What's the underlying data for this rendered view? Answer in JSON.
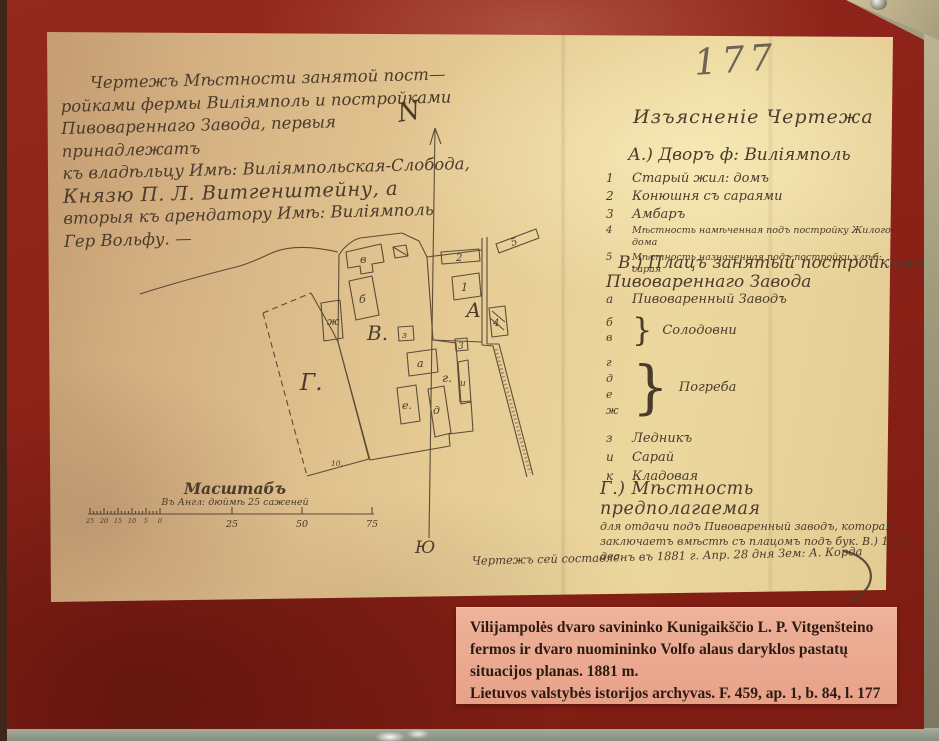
{
  "archive_number": "177",
  "title_block": {
    "lines": [
      "Чертежъ Мѣстности занятой пост—",
      "ройками фермы Виліямполь и постройками",
      "Пивовареннаго Завода, первыя принадлежатъ",
      "къ владѣльцу Имѣ: Виліямпольская-Слобода,",
      "Князю П. Л. Витгенштейну, а",
      "вторыя къ арендатору Имѣ: Виліямполь",
      "Гер Вольфу. —"
    ]
  },
  "legend": {
    "heading": "Изъясненіе Чертежа",
    "section_a": {
      "heading": "А.) Дворъ ф: Виліямполь",
      "items": [
        {
          "key": "1",
          "text": "Старый жил: домъ"
        },
        {
          "key": "2",
          "text": "Конюшня съ сараями"
        },
        {
          "key": "3",
          "text": "Амбаръ"
        },
        {
          "key": "4",
          "text": "Мѣстность намѣченная подъ постройку Жилого дома"
        },
        {
          "key": "5",
          "text": "Мѣстность назначенная подъ постройки хлѣб: сарая"
        }
      ]
    },
    "section_b": {
      "heading_line1": "В.) Плацъ занятый постройками",
      "heading_line2": "Пивовареннаго Завода",
      "item_a": {
        "key": "а",
        "text": "Пивоваренный Заводъ"
      },
      "group_solodovni": {
        "keys": [
          "б",
          "в"
        ],
        "text": "Солодовни"
      },
      "group_pogreba": {
        "keys": [
          "г",
          "д",
          "е",
          "ж"
        ],
        "text": "Погреба"
      },
      "items": [
        {
          "key": "з",
          "text": "Ледникъ"
        },
        {
          "key": "и",
          "text": "Сарай"
        },
        {
          "key": "к",
          "text": "Кладовая"
        }
      ]
    },
    "section_g": {
      "heading": "Г.) Мѣстность предполагаемая",
      "line2": "для отдачи подъ Пивоваренный заводъ, которая",
      "line3": "заключаетъ вмѣстѣ съ плацомъ подъ бук. В.) 1,75 дес."
    }
  },
  "plan": {
    "parcel_labels": [
      "Г.",
      "В.",
      "А"
    ],
    "building_labels_v": [
      "в",
      "б",
      "ж",
      "з",
      "а",
      "г.",
      "е.",
      "д",
      "и"
    ],
    "building_labels_a": [
      "1",
      "2",
      "3",
      "4",
      "5"
    ],
    "area_note": "10.",
    "compass_north": "N",
    "compass_south": "Ю"
  },
  "scale": {
    "title": "Масштабъ",
    "subtitle": "Въ Англ: дюймѣ 25 саженей",
    "left_labels": [
      "25",
      "20",
      "15",
      "10",
      "5",
      "0"
    ],
    "main_labels": [
      "25",
      "50",
      "75"
    ]
  },
  "signature": {
    "text": "Чертежъ сей составленъ въ 1881 г. Апр. 28 дня Зем: А. Корда"
  },
  "caption": {
    "lines": [
      "Vilijampolės dvaro savininko Kunigaikščio L. P. Vitgenšteino",
      "fermos ir dvaro nuomininko Volfo alaus daryklos pastatų",
      "situacijos planas.  1881 m.",
      "Lietuvos valstybės istorijos archyvas. F. 459, ap. 1, b. 84, l. 177"
    ]
  },
  "colors": {
    "board_red": "#8c2218",
    "paper_tan": "#e3c98f",
    "label_salmon": "#e9a68e",
    "ink_brown": "#4a3b2c",
    "pencil_gray": "#6e6354"
  }
}
